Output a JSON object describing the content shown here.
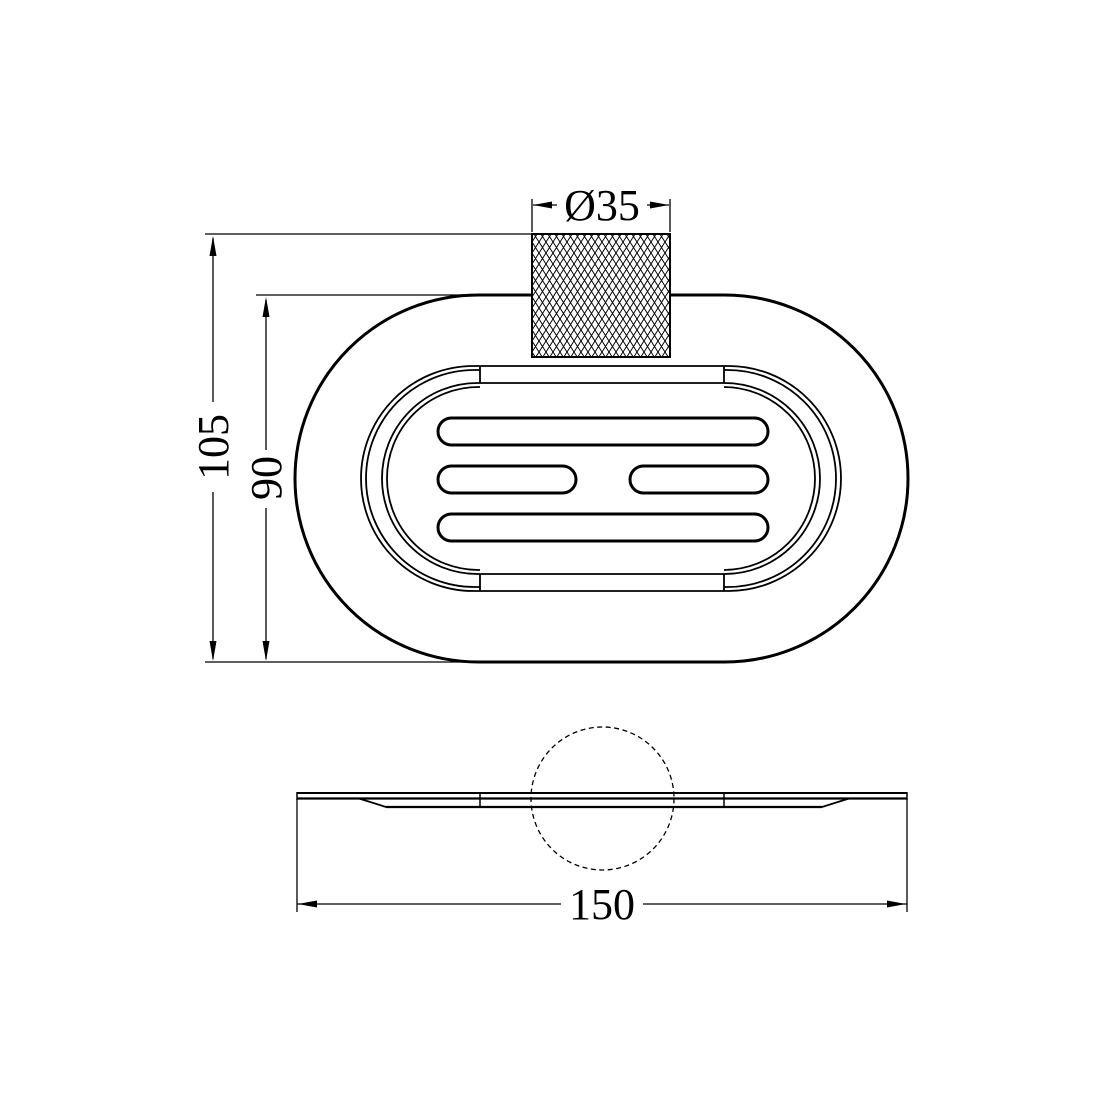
{
  "page": {
    "background": "#ffffff",
    "line_color": "#000000"
  },
  "drawing": {
    "type": "technical-drawing",
    "subject": "oval soap dish with knurled knob",
    "views": {
      "top_view": "top view: stadium-shaped dish, inner rims, four drain slots, knurled knob",
      "side_view": "side profile: thin plate with hidden knob shown as dashed circle"
    },
    "dimensions": {
      "knob_diameter": "Ø35",
      "overall_height": "105",
      "dish_height": "90",
      "overall_width": "150"
    }
  }
}
